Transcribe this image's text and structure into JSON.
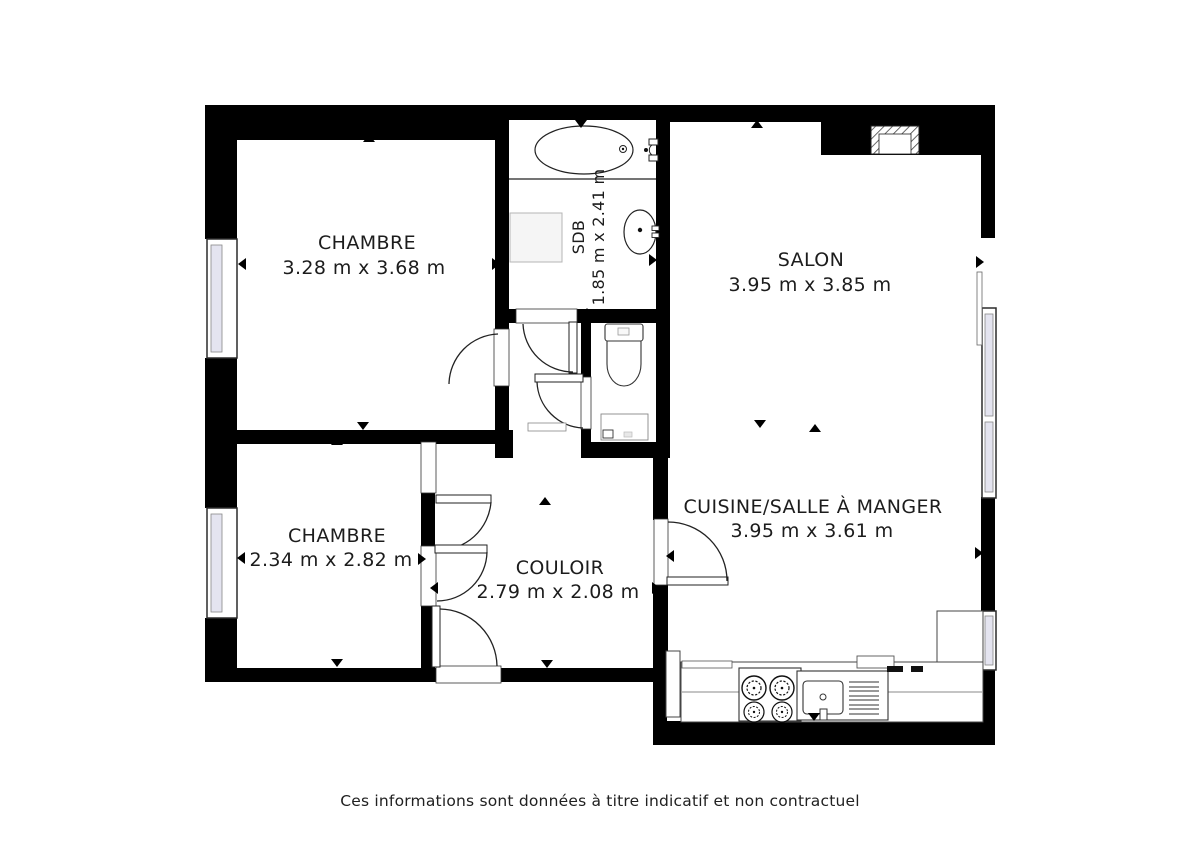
{
  "plan": {
    "type": "apartment-floor-plan",
    "rooms": [
      {
        "id": "chambre-1",
        "name": "CHAMBRE",
        "dimensions": "3.28 m x 3.68 m"
      },
      {
        "id": "sdb",
        "name": "SDB",
        "dimensions": "1.85 m x 2.41 m"
      },
      {
        "id": "salon",
        "name": "SALON",
        "dimensions": "3.95 m x 3.85 m"
      },
      {
        "id": "chambre-2",
        "name": "CHAMBRE",
        "dimensions": "2.34 m x 2.82 m"
      },
      {
        "id": "couloir",
        "name": "COULOIR",
        "dimensions": "2.79 m x 2.08 m"
      },
      {
        "id": "cuisine",
        "name": "CUISINE/SALLE À MANGER",
        "dimensions": "3.95 m x 3.61 m"
      }
    ],
    "fixtures": [
      "bathtub",
      "washbasin",
      "shower-tray",
      "toilet",
      "stove",
      "kitchen-sink",
      "kitchen-counter",
      "flue",
      "window",
      "door-swing",
      "entrance-door",
      "dimension-arrow"
    ],
    "colors": {
      "wall": "#000000",
      "line": "#222222",
      "window_fill": "#e4e4f0",
      "text": "#1c1c1c"
    }
  },
  "footer": {
    "disclaimer": "Ces informations sont données à titre indicatif et non contractuel"
  }
}
